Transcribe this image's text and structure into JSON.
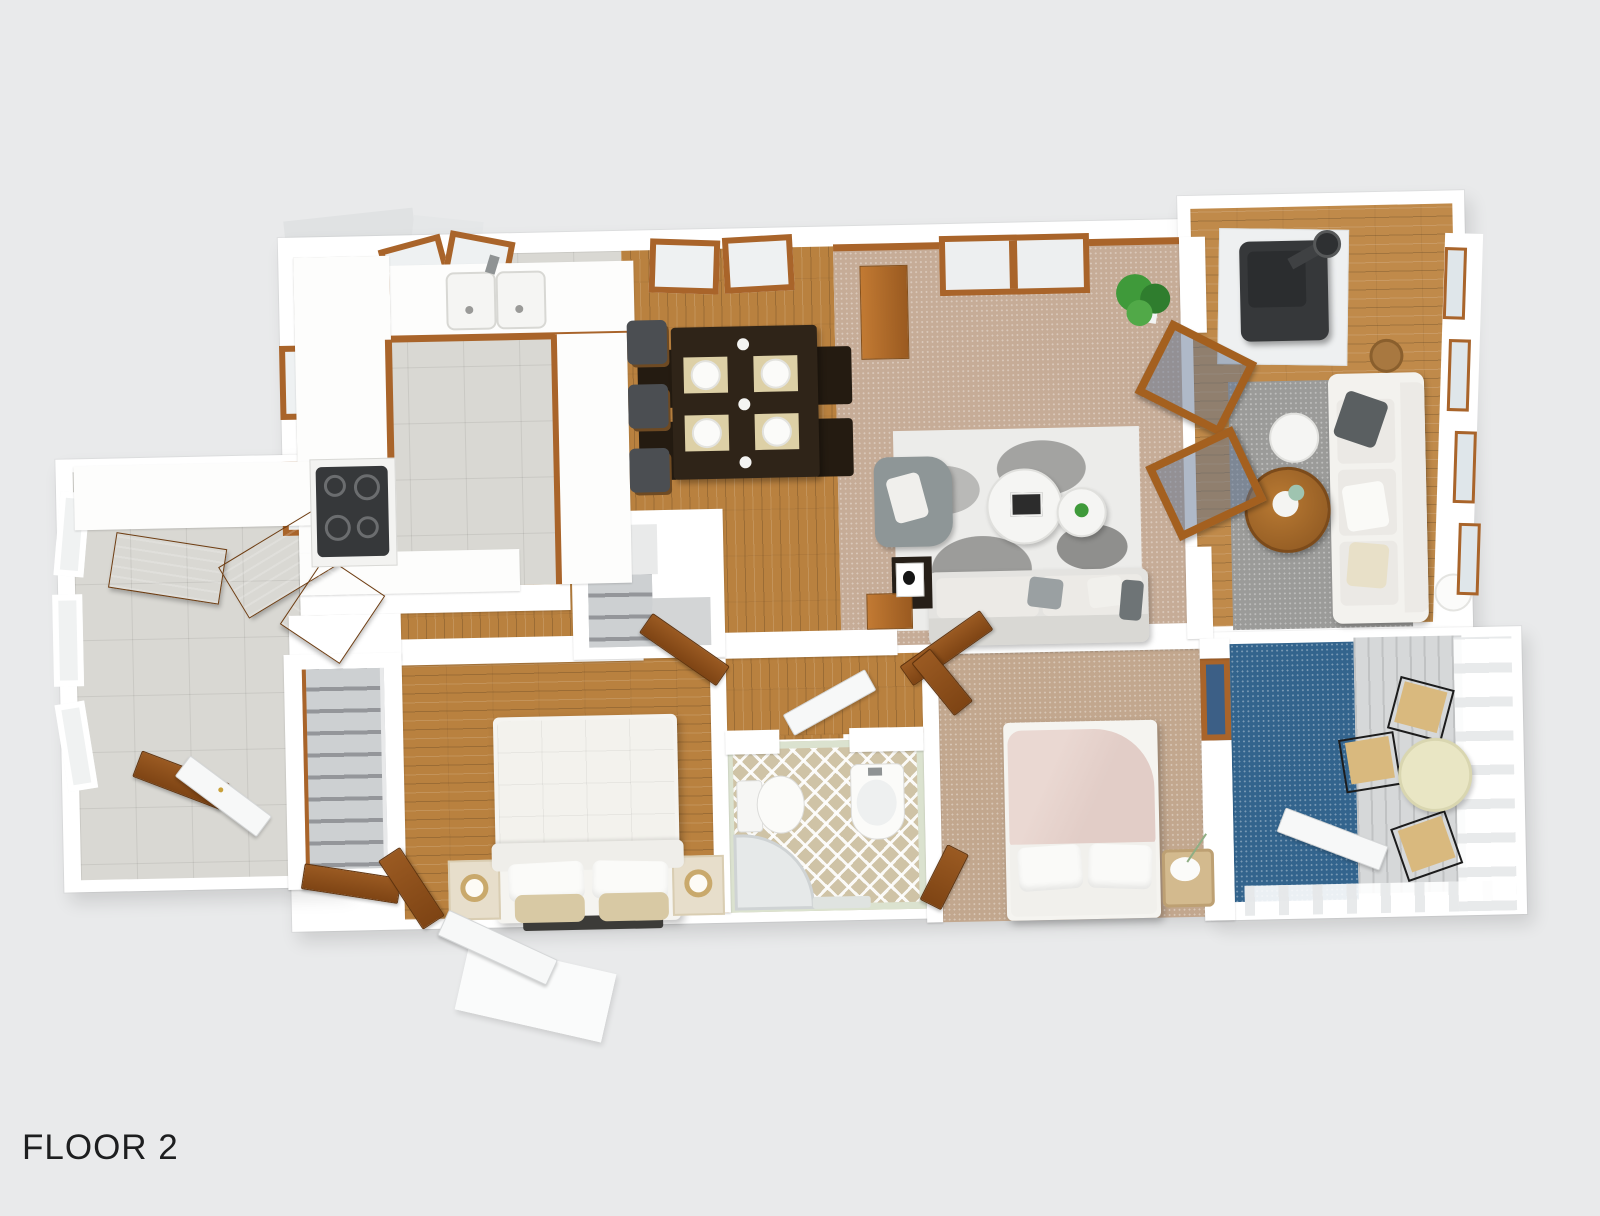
{
  "label": {
    "title": "FLOOR 2"
  },
  "palette": {
    "background": "#e9eaeb",
    "wall": "#ffffff",
    "wood_floor": "#b9813f",
    "wood_trim": "#a9642a",
    "tile_floor": "#d9d8d3",
    "carpet_living": "#c6ac97",
    "carpet_bedroom": "#c2a78e",
    "rug_gray": "#9b9b99",
    "rug_blue": "#33648d",
    "deck_gray": "#d6d8d9",
    "bath_floor": "#cfc3a6",
    "bath_wall": "#dbe2cf",
    "sofa_light": "#e4e3e0",
    "sofa_white": "#f3f2ee",
    "armchair_gray": "#8e9697",
    "dining_dark": "#2f2418",
    "stool_seat": "#4b4e52",
    "stove_black": "#36383a",
    "bed_white": "#f5f4f0",
    "duvet_pink": "#e2cdc7",
    "pillow_tan": "#d8c9a4",
    "stair_carpet": "#c5c7c9",
    "porch_table": "#e9e6c4",
    "porch_chair": "#d9b97e",
    "plant_green": "#3f9a3a",
    "text": "#1d1e1f"
  }
}
